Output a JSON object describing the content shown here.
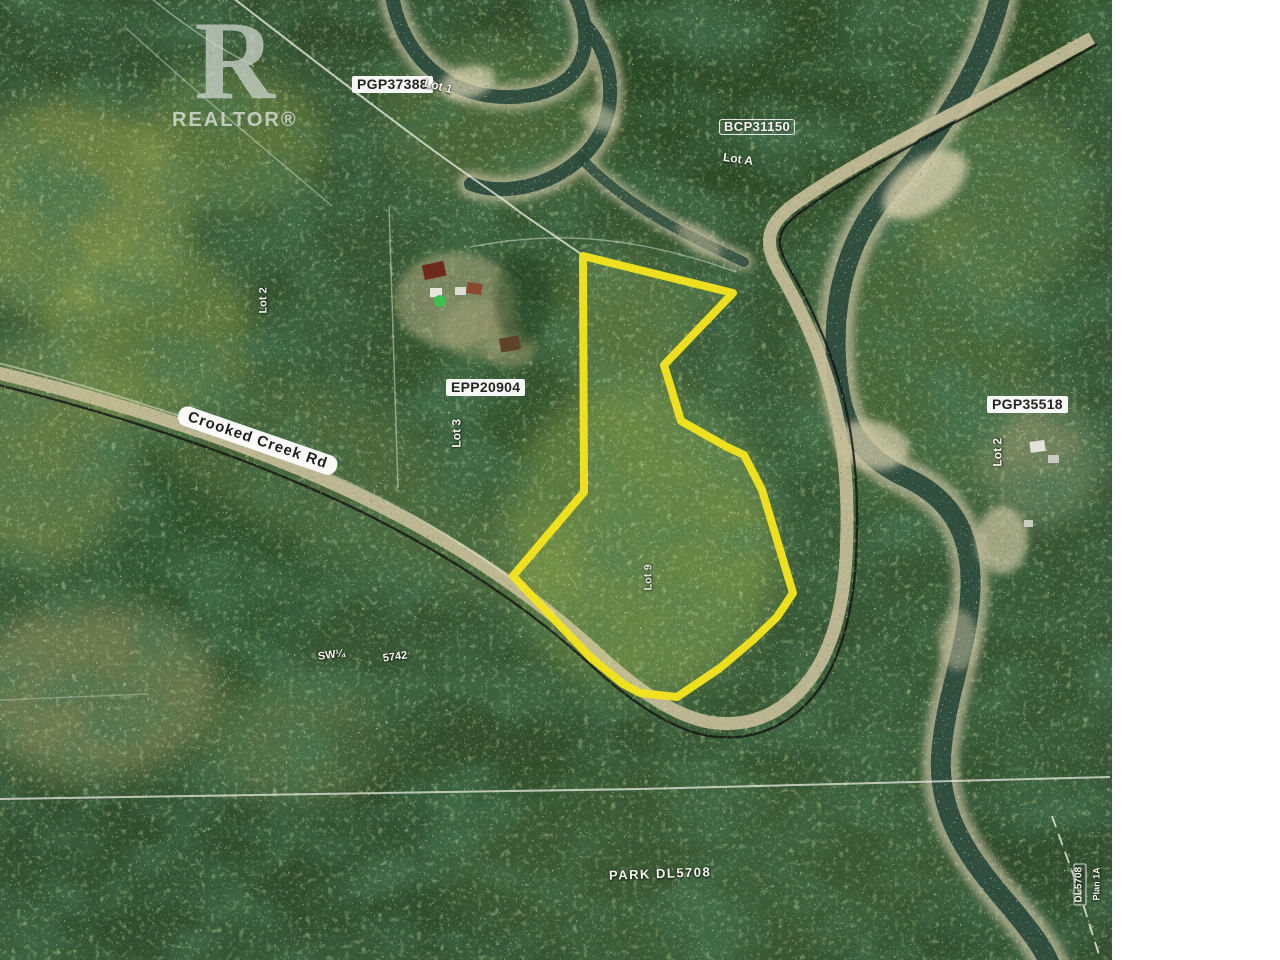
{
  "photo": {
    "type": "aerial-parcel-map",
    "watermark": {
      "logo_letter": "R",
      "brand": "REALTOR®"
    },
    "labels": {
      "plan_pgp37388": "PGP37388",
      "lot_1": "Lot 1",
      "plan_bcp31150": "BCP31150",
      "lot_a": "Lot A",
      "plan_epp20904": "EPP20904",
      "lot_3": "Lot 3",
      "road_name": "Crooked Creek Rd",
      "plan_pgp35518": "PGP35518",
      "lot_2_east": "Lot 2",
      "lot_2_west": "Lot 2",
      "lot_9": "Lot 9",
      "quarter_section": "SW¼",
      "district_lot_west": "5742",
      "park": "PARK DL5708",
      "district_lot_5708": "DL5708",
      "plan_note": "Plan 1A"
    },
    "colors": {
      "boundary_highlight": "#f3e41e",
      "forest": "#375633",
      "water": "#2a4a3c",
      "road": "#c6bd98",
      "label_background": "#ffffff",
      "label_text": "#242424",
      "page_background": "#ffffff"
    }
  }
}
